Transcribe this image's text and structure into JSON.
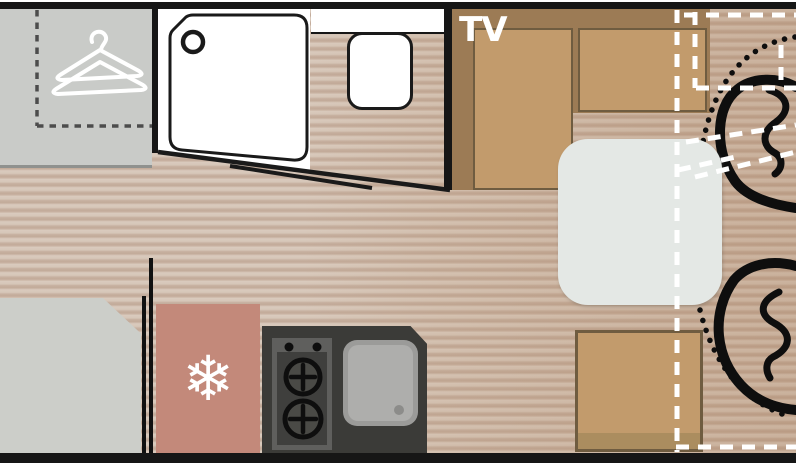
{
  "floorplan": {
    "tv_label": "TV",
    "snowflake_glyph": "❄",
    "icons": {
      "wardrobe": "hanger-icon",
      "fridge": "snowflake-icon",
      "shower": "drain-icon",
      "hob": "burner-icon",
      "sink": "drain-dot-icon"
    },
    "elements": [
      "wardrobe",
      "shower",
      "toilet",
      "washroom-counter",
      "tv-cabinet",
      "dinette-cushion-left",
      "dinette-cushion-right",
      "dinette-bench-bottom",
      "table",
      "gray-unit",
      "fridge",
      "kitchen-counter",
      "hob",
      "sink",
      "swivel-cab-seat-top",
      "swivel-cab-seat-bottom",
      "swivel-arc",
      "dashed-conversion-outline",
      "bathroom-door-line"
    ],
    "colors": {
      "wall": "#161616",
      "floor_light": "#dacbbe",
      "floor_dark": "#c2aa99",
      "wardrobe_gray": "#c9cbc8",
      "cabinet_brown": "#9c7b55",
      "cushion_tan": "#c29b6c",
      "cushion_border": "#6f5c40",
      "bench_shadow": "#ab8d5f",
      "fridge_red": "#c3897a",
      "kitchen_dark": "#3b3b38",
      "sink_gray": "#aeaeac",
      "table_gray": "#e4e8e5",
      "unit_gray": "#cccec9",
      "seat_outline": "#0e0e0e",
      "overlay_dash": "#ffffff",
      "wardrobe_dash": "#4c4c4c"
    }
  }
}
